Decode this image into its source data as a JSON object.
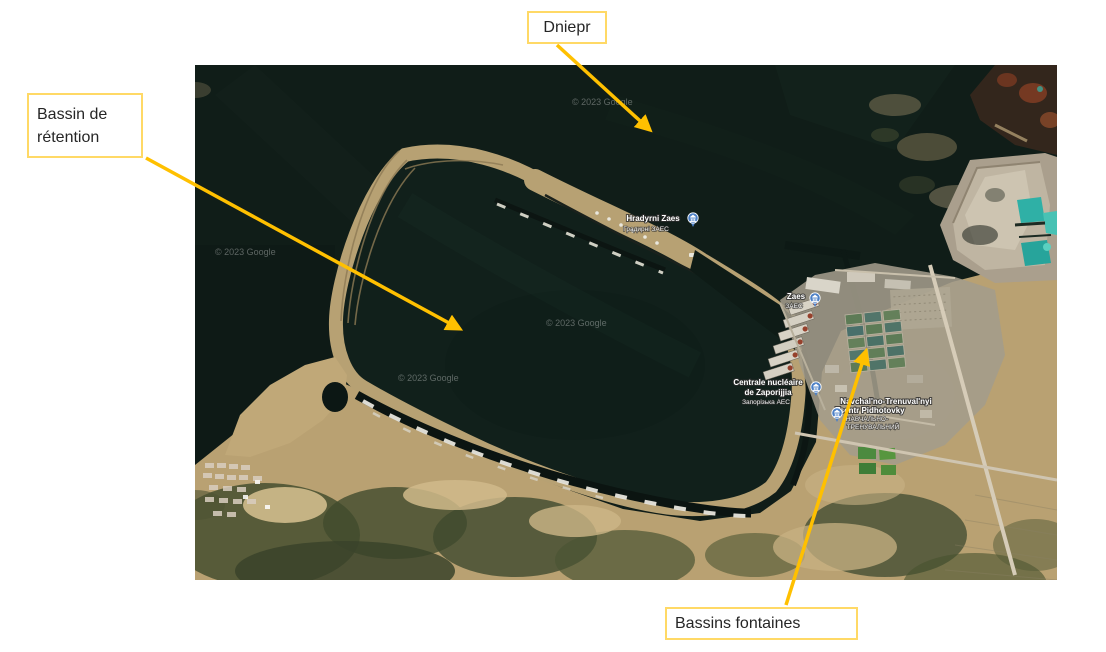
{
  "slide": {
    "background_color": "#ffffff"
  },
  "callouts": {
    "dniepr": {
      "text": "Dniepr"
    },
    "retention": {
      "line1": "Bassin de",
      "line2": "rétention"
    },
    "fontaines": {
      "text": "Bassins fontaines"
    },
    "style": {
      "arrow_color": "#FFC000",
      "border_color": "#FFD966",
      "fill_color": "#FFFFFF",
      "text_color": "#262626"
    }
  },
  "map": {
    "watermark": "© 2023 Google",
    "pois": [
      {
        "line1": "Hradyrni Zaes",
        "line2": "Градирні ЗАЕС"
      },
      {
        "line1": "Zaes",
        "line2": "ЗАЕС"
      },
      {
        "line1": "Centrale nucléaire",
        "line2": "de Zaporijjia",
        "line3": "Запорізька АЕС"
      },
      {
        "line1": "Navchal'no-Trenuval'nyi",
        "line2": "Tsentr Pidhotovky",
        "line3": "НАВЧАЛЬНО-",
        "line4": "ТРЕНУВАЛЬНИЙ"
      }
    ],
    "colors": {
      "water": "#101d18",
      "pond": "#11201b",
      "sand": "#b7a173",
      "vegetation": "#454f2f",
      "industrial": "#a39c8b",
      "turquoise": "#38b7ac",
      "pin": "#4c80c6"
    }
  }
}
